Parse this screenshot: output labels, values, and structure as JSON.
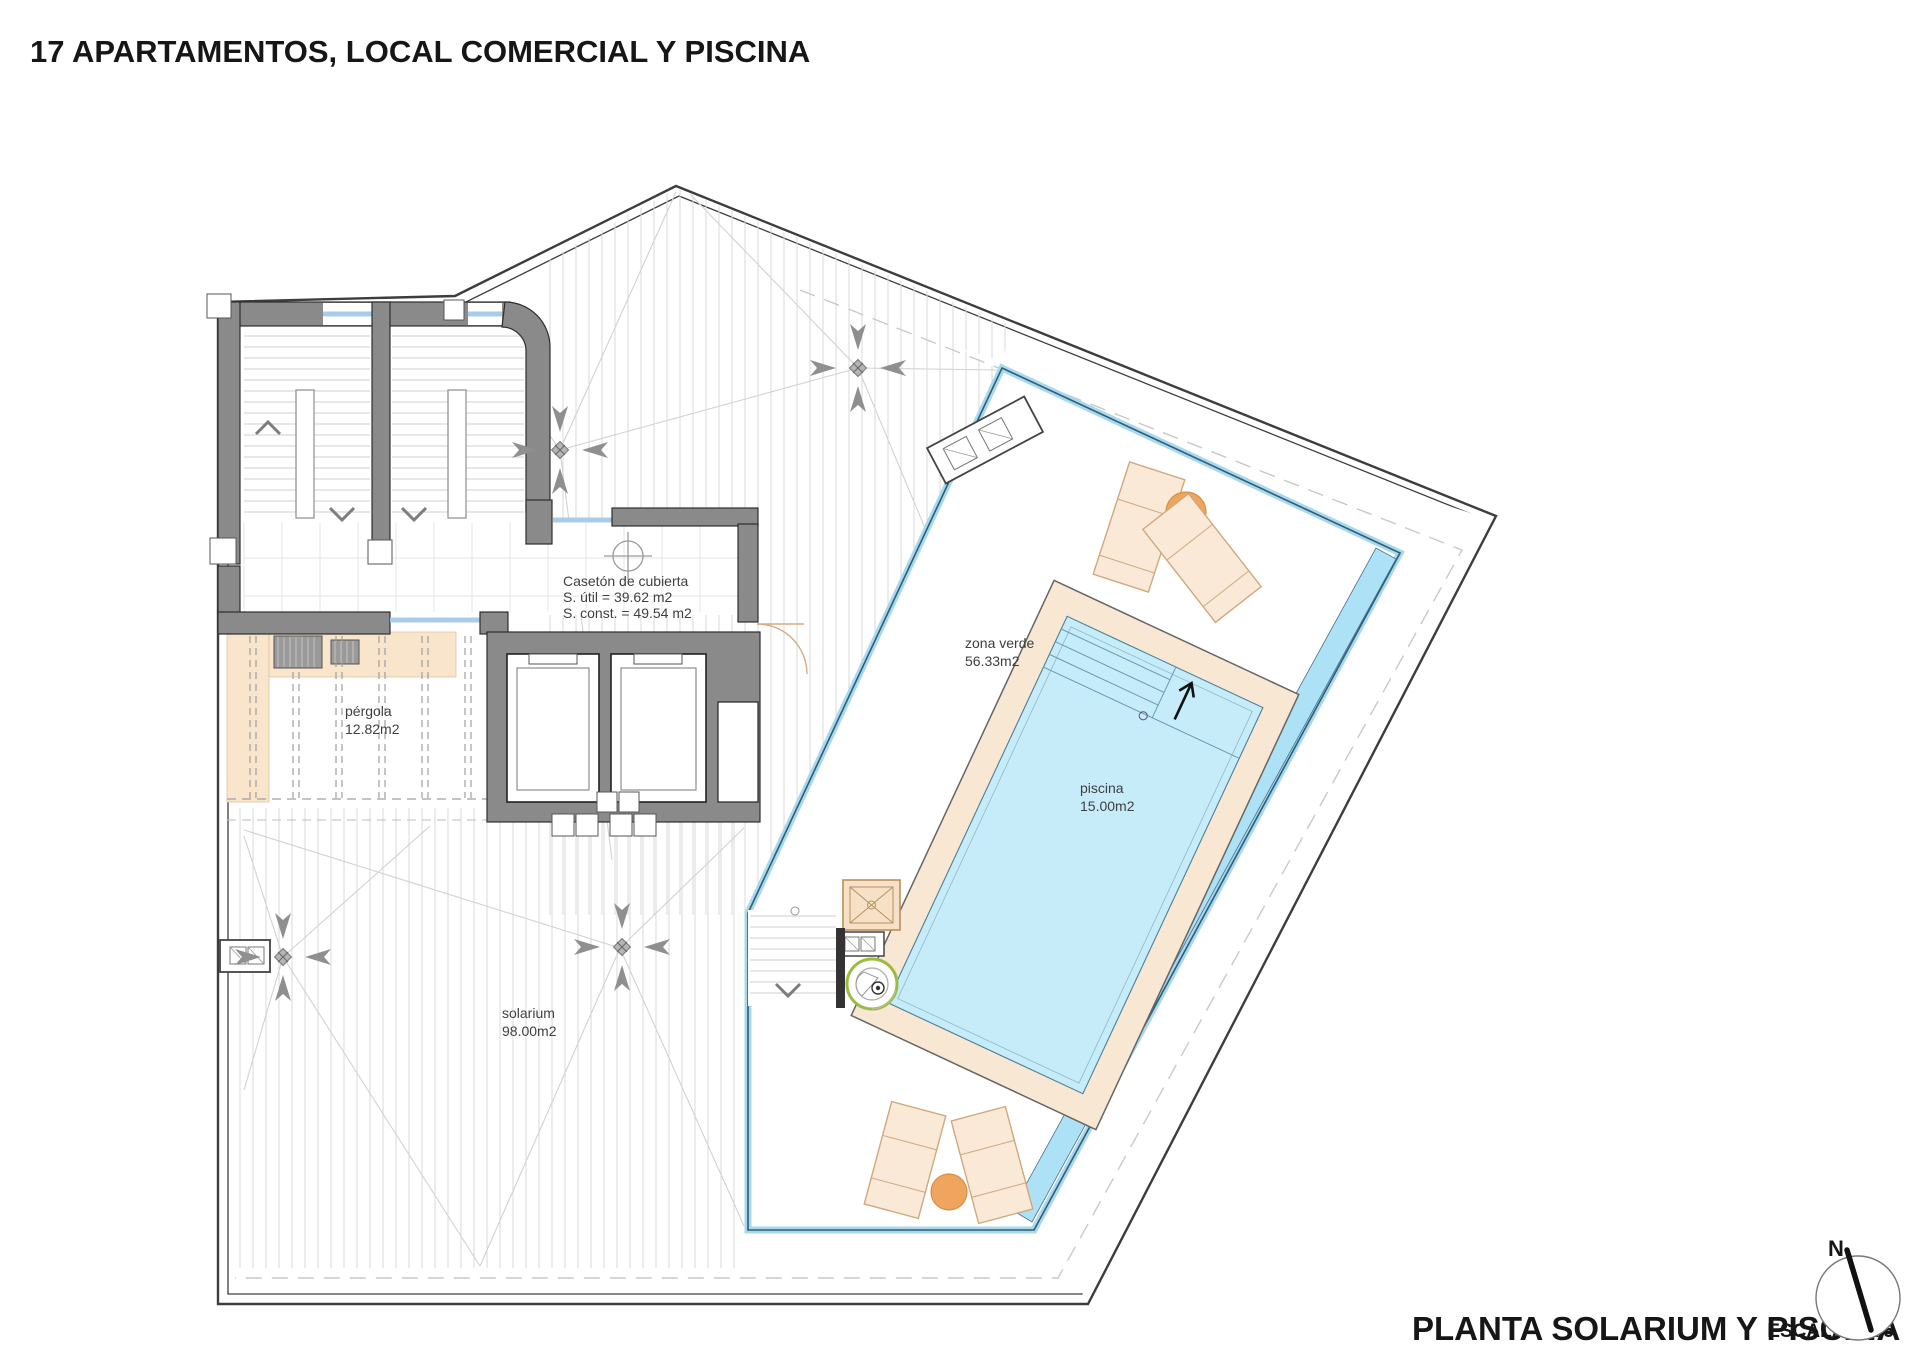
{
  "title": "17 APARTAMENTOS, LOCAL COMERCIAL Y PISCINA",
  "footer": {
    "plan_title": "PLANTA SOLARIUM Y PISCINA",
    "scale": "ESCALA: 1/75"
  },
  "compass": {
    "north": "N"
  },
  "labels": {
    "caseton": {
      "name": "Casetón de cubierta",
      "util": "S. útil = 39.62 m2",
      "const": "S. const. = 49.54 m2"
    },
    "pergola": {
      "name": "pérgola",
      "area": "12.82m2"
    },
    "zona_verde": {
      "name": "zona verde",
      "area": "56.33m2"
    },
    "piscina": {
      "name": "piscina",
      "area": "15.00m2"
    },
    "solarium": {
      "name": "solarium",
      "area": "98.00m2"
    }
  },
  "colors": {
    "wall_gray": "#8a8a8a",
    "pool_water": "#c6ecfa",
    "overflow_channel": "#ade2f6",
    "balustrade_blue": "#a8d8ee",
    "deck_beige": "#f8e7d2",
    "furniture_beige": "#f9e9d6",
    "table_orange": "#f0a55f",
    "shower_green": "#9abc3f",
    "window_blue": "#a9cde8",
    "text_dark": "#161616"
  }
}
